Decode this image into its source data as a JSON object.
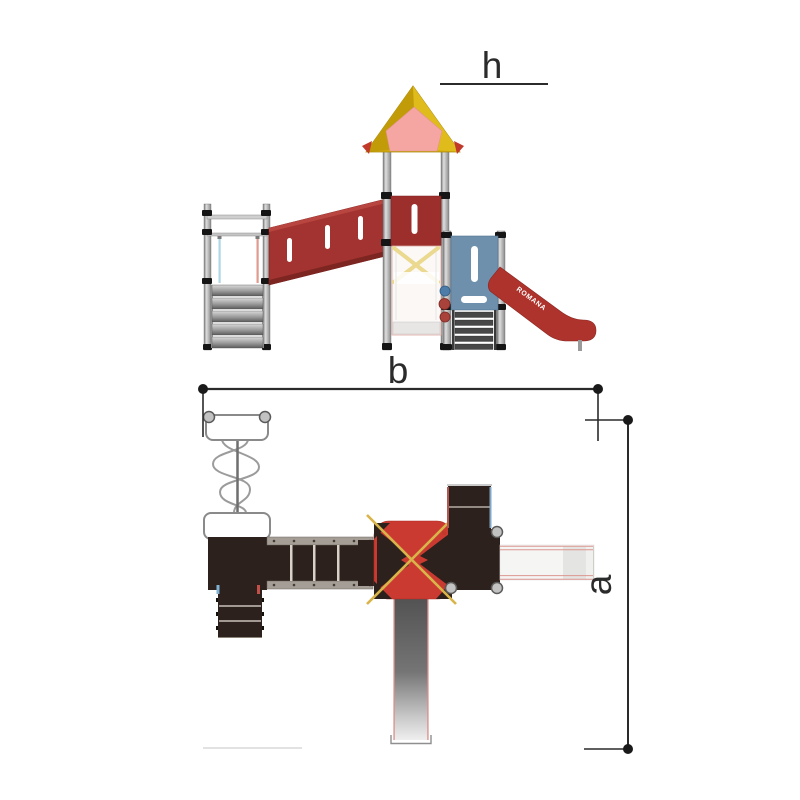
{
  "drawing": {
    "dimension_labels": {
      "height": "h",
      "width": "b",
      "depth": "a"
    },
    "slide_brand": "ROMANA",
    "colors": {
      "dimension_line": "#2a2a2a",
      "ramp_red": "#a23330",
      "panel_red": "#9c2e2b",
      "slide_red": "#ae332c",
      "plan_roof_red": "#ca3a31",
      "roof_yellow": "#d4ad0e",
      "gable_pink": "#f6a6a2",
      "panel_blue": "#6e90ac",
      "platform_brown": "#2c211c",
      "rope_gold": "#d9b44a",
      "post_gray": "#9a9a9a",
      "pole_blue": "#aed6e6",
      "pole_red": "#e09a8e"
    }
  }
}
